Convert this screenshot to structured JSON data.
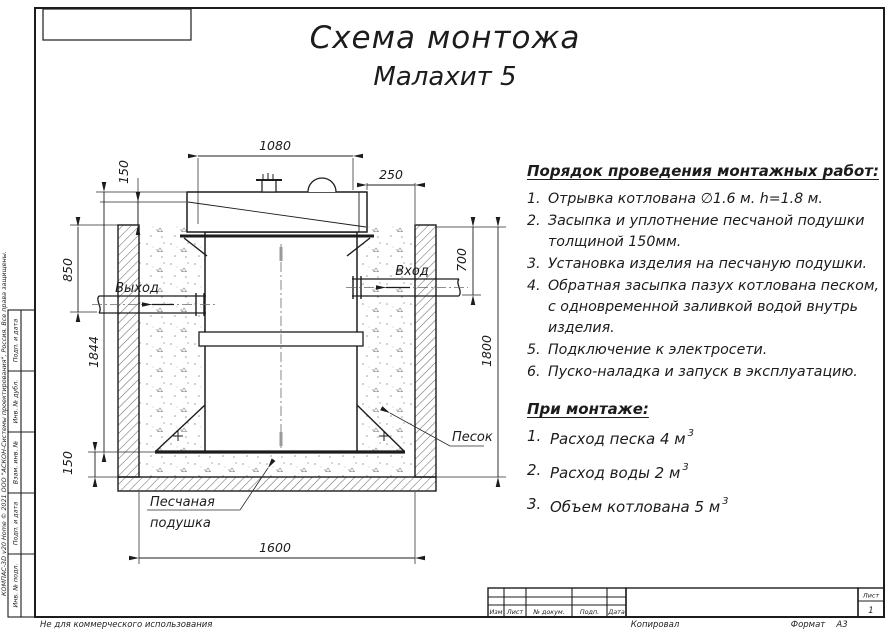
{
  "page": {
    "watermark": "КОМПАС-3D v20 Home © 2021 ООО \"АСКОН-Системы проектирования\", Россия. Все права защищены.",
    "footer_left": "Не для коммерческого использования",
    "footer_copy": "Копировал",
    "footer_format_label": "Формат",
    "footer_format_value": "А3"
  },
  "titles": {
    "line1": "Схема монтожа",
    "line2": "Малахит 5"
  },
  "instructions": {
    "heading": "Порядок проведения монтажных работ:",
    "steps": [
      {
        "num": "1.",
        "text": "Отрывка котлована ∅1.6 м. h=1.8 м."
      },
      {
        "num": "2.",
        "text": "Засыпка и уплотнение песчаной подушки толщиной 150мм."
      },
      {
        "num": "3.",
        "text": "Установка изделия на песчаную подушки."
      },
      {
        "num": "4.",
        "text": "Обратная засыпка пазух котлована песком, с одновременной заливкой водой внутрь изделия."
      },
      {
        "num": "5.",
        "text": "Подключение к электросети."
      },
      {
        "num": "6.",
        "text": "Пуско-наладка и запуск в эксплуатацию."
      }
    ]
  },
  "montage": {
    "heading": "При монтаже:",
    "items": [
      {
        "num": "1.",
        "text": "Расход песка 4 м",
        "sup": "3"
      },
      {
        "num": "2.",
        "text": "Расход воды 2 м",
        "sup": "3"
      },
      {
        "num": "3.",
        "text": "Объем котлована 5 м",
        "sup": "3"
      }
    ]
  },
  "drawing": {
    "dims": {
      "lid_width": "1080",
      "right_offset": "250",
      "lid_height": "150",
      "outlet_depth": "850",
      "unit_height": "1844",
      "cushion_thickness": "150",
      "pit_width": "1600",
      "inlet_depth": "700",
      "pit_depth": "1800"
    },
    "labels": {
      "outlet": "Выход",
      "inlet": "Вход",
      "sand": "Песок",
      "cushion_l1": "Песчаная",
      "cushion_l2": "подушка"
    }
  },
  "stamp": {
    "side_labels": [
      "Подп. и дата",
      "Инв. № дубл.",
      "Взам. инв. №",
      "Подп. и дата",
      "Инв. № подл."
    ],
    "bottom_cols": [
      "Изм",
      "Лист",
      "№ докум.",
      "Подп.",
      "Дата"
    ],
    "sheet_label": "Лист",
    "sheet_value": "1"
  },
  "colors": {
    "line": "#1c1c1e",
    "hatch": "#6e6e6e",
    "sand_dot": "#9a9a9a"
  }
}
